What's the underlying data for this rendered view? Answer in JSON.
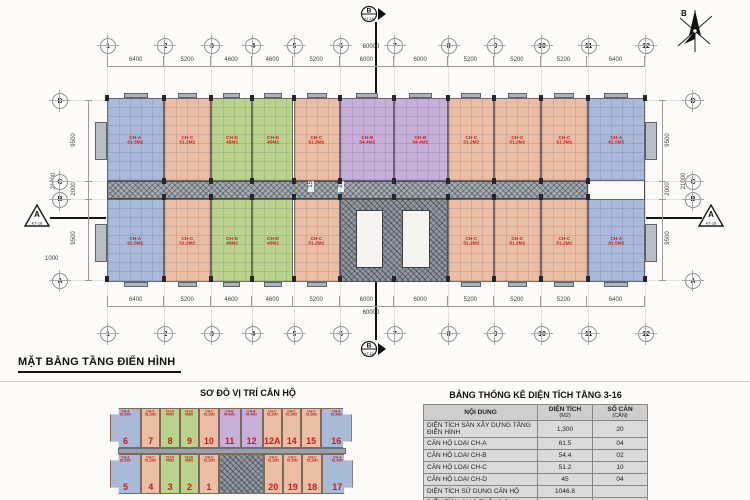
{
  "sheet": {
    "plan_title": "MẶT BẰNG TẦNG ĐIỂN HÌNH",
    "north_label": "B"
  },
  "plan": {
    "axes_h": [
      "1",
      "2",
      "3",
      "4",
      "5",
      "6",
      "7",
      "8",
      "9",
      "10",
      "11",
      "12"
    ],
    "dims_h_mm": [
      6400,
      5200,
      4600,
      4600,
      5200,
      6000,
      6000,
      5200,
      5200,
      5200,
      6400
    ],
    "total_h": "60000",
    "axes_v": [
      "D",
      "C",
      "B",
      "A"
    ],
    "dims_v_mm": [
      9500,
      2000,
      9500
    ],
    "total_v": "21000",
    "aux_dims": {
      "left_bottom": "1000",
      "corridor_a": "1500",
      "corridor_b": "2700",
      "core": "3000"
    },
    "section_markers": {
      "horizontal": {
        "label": "A",
        "ref": "KT-18"
      },
      "vertical": {
        "label": "B",
        "ref": "KT-18"
      }
    },
    "units_top": [
      {
        "from": 1,
        "to": 2,
        "type": "CH-A"
      },
      {
        "from": 2,
        "to": 3,
        "type": "CH-C"
      },
      {
        "from": 3,
        "to": 4,
        "type": "CH-D"
      },
      {
        "from": 4,
        "to": 5,
        "type": "CH-D"
      },
      {
        "from": 5,
        "to": 6,
        "type": "CH-C"
      },
      {
        "from": 6,
        "to": 7,
        "type": "CH-B"
      },
      {
        "from": 7,
        "to": 8,
        "type": "CH-B"
      },
      {
        "from": 8,
        "to": 9,
        "type": "CH-C"
      },
      {
        "from": 9,
        "to": 10,
        "type": "CH-C"
      },
      {
        "from": 10,
        "to": 11,
        "type": "CH-C"
      },
      {
        "from": 11,
        "to": 12,
        "type": "CH-A"
      }
    ],
    "units_bottom": [
      {
        "from": 1,
        "to": 2,
        "type": "CH-A"
      },
      {
        "from": 2,
        "to": 3,
        "type": "CH-C"
      },
      {
        "from": 3,
        "to": 4,
        "type": "CH-D"
      },
      {
        "from": 4,
        "to": 5,
        "type": "CH-D"
      },
      {
        "from": 5,
        "to": 6,
        "type": "CH-C"
      },
      {
        "from": 6,
        "to": 8,
        "type": "CORE"
      },
      {
        "from": 8,
        "to": 9,
        "type": "CH-C"
      },
      {
        "from": 9,
        "to": 10,
        "type": "CH-C"
      },
      {
        "from": 10,
        "to": 11,
        "type": "CH-C"
      },
      {
        "from": 11,
        "to": 12,
        "type": "CH-A"
      }
    ]
  },
  "unit_types": {
    "CH-A": {
      "code": "CH-A",
      "area": "61.5M2",
      "color": "#a9b9d8"
    },
    "CH-B": {
      "code": "CH-B",
      "area": "54.4M2",
      "color": "#c6afd8"
    },
    "CH-C": {
      "code": "CH-C",
      "area": "51.2M2",
      "color": "#eabda4"
    },
    "CH-D": {
      "code": "CH-D",
      "area": "45M2",
      "color": "#b9d28c"
    },
    "CORE": {
      "code": "",
      "area": "",
      "color": "#9298a0"
    }
  },
  "locator": {
    "title": "SƠ ĐỒ VỊ TRÍ CĂN HỘ",
    "top_row": [
      {
        "no": "6",
        "type": "CH-A"
      },
      {
        "no": "7",
        "type": "CH-C"
      },
      {
        "no": "8",
        "type": "CH-D"
      },
      {
        "no": "9",
        "type": "CH-D"
      },
      {
        "no": "10",
        "type": "CH-C"
      },
      {
        "no": "11",
        "type": "CH-B"
      },
      {
        "no": "12",
        "type": "CH-B"
      },
      {
        "no": "12A",
        "type": "CH-C"
      },
      {
        "no": "14",
        "type": "CH-C"
      },
      {
        "no": "15",
        "type": "CH-C"
      },
      {
        "no": "16",
        "type": "CH-A"
      }
    ],
    "bottom_row": [
      {
        "no": "5",
        "type": "CH-A"
      },
      {
        "no": "4",
        "type": "CH-C"
      },
      {
        "no": "3",
        "type": "CH-D"
      },
      {
        "no": "2",
        "type": "CH-D"
      },
      {
        "no": "1",
        "type": "CH-C"
      },
      {
        "no": "",
        "type": "CORE"
      },
      {
        "no": "20",
        "type": "CH-C"
      },
      {
        "no": "19",
        "type": "CH-C"
      },
      {
        "no": "18",
        "type": "CH-C"
      },
      {
        "no": "17",
        "type": "CH-A"
      }
    ]
  },
  "stats_table": {
    "title": "BẢNG THỐNG KÊ DIỆN TÍCH TẦNG 3-16",
    "headers": [
      {
        "line1": "NỘI DUNG",
        "line2": ""
      },
      {
        "line1": "DIỆN TÍCH",
        "line2": "(M2)"
      },
      {
        "line1": "SỐ CĂN",
        "line2": "(CĂN)"
      }
    ],
    "rows": [
      [
        "DIỆN TÍCH SÀN XÂY DỰNG TẦNG ĐIỂN HÌNH",
        "1,300",
        "20"
      ],
      [
        "CĂN HỘ LOẠI CH-A",
        "61.5",
        "04"
      ],
      [
        "CĂN HỘ LOẠI CH-B",
        "54.4",
        "02"
      ],
      [
        "CĂN HỘ LOẠI CH-C",
        "51.2",
        "10"
      ],
      [
        "CĂN HỘ LOẠI CH-D",
        "45",
        "04"
      ],
      [
        "DIỆN TÍCH SỬ DỤNG CĂN HỘ",
        "1046.8",
        ""
      ],
      [
        "DIỆN TÍCH GIAO THÔNG PHỤ TRỢ",
        "303.2",
        ""
      ]
    ]
  }
}
